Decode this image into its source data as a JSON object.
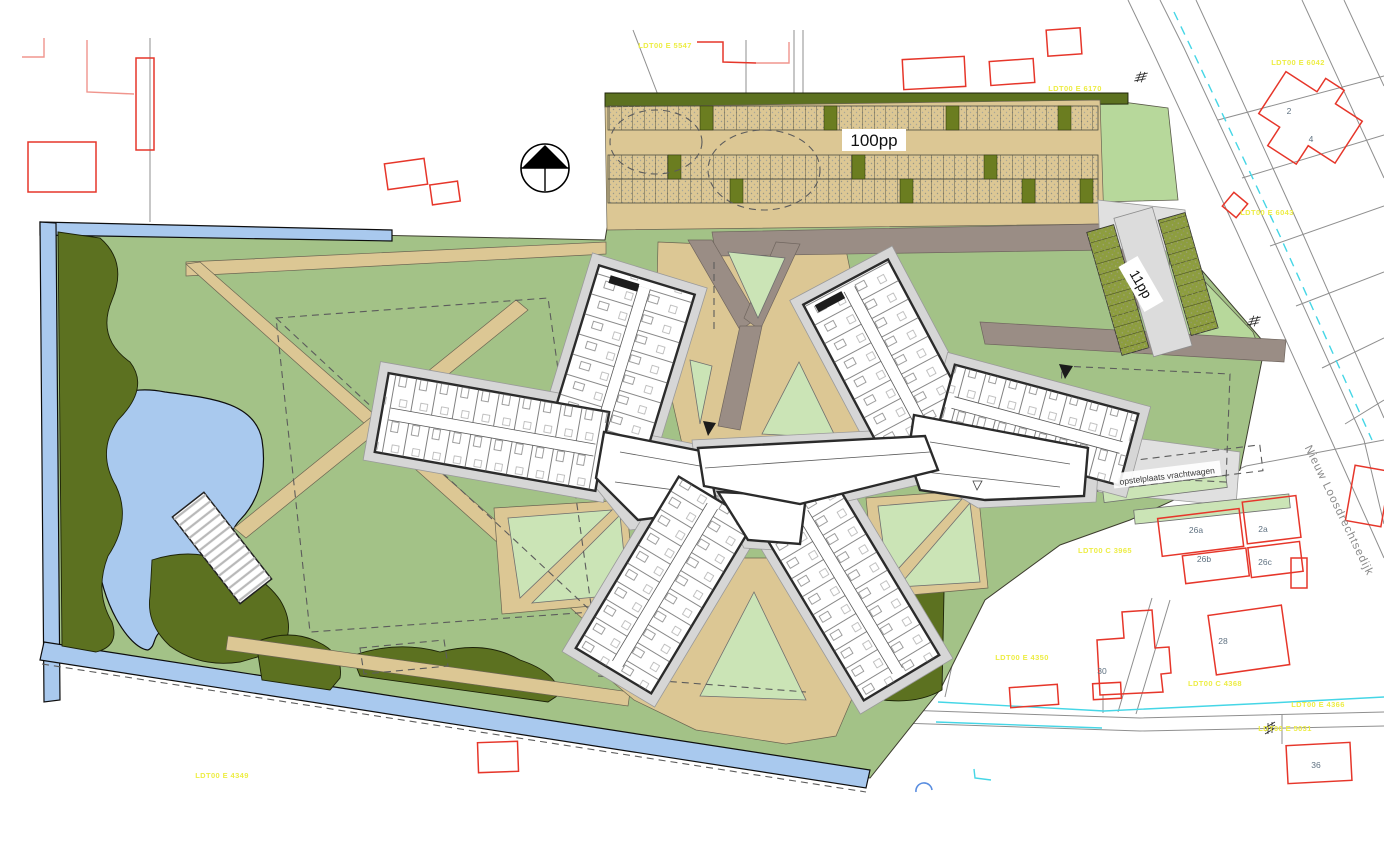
{
  "drawing": {
    "type": "architectural-site-plan",
    "labels": {
      "parking_capacity": "100pp",
      "small_parking_capacity": "11pp",
      "truck_staging_area": "opstelplaats vrachtwagen",
      "street_name": "Nieuw Loosdrechtsedijk"
    },
    "house_numbers": [
      {
        "text": "2"
      },
      {
        "text": "4"
      },
      {
        "text": "26a"
      },
      {
        "text": "2a"
      },
      {
        "text": "26b"
      },
      {
        "text": "26c"
      },
      {
        "text": "30"
      },
      {
        "text": "28"
      },
      {
        "text": "36"
      }
    ],
    "cadastral_labels": [
      {
        "text": "LDT00 E 5547"
      },
      {
        "text": "LDT00 E 6042"
      },
      {
        "text": "LDT00 E 6170"
      },
      {
        "text": "LDT00 E 6043"
      },
      {
        "text": "LDT00 C 3965"
      },
      {
        "text": "LDT00 E 4350"
      },
      {
        "text": "LDT00 C 4368"
      },
      {
        "text": "LDT00 E 4366"
      },
      {
        "text": "LDT00 E 5031"
      },
      {
        "text": "LDT00 E 4349"
      }
    ],
    "icons": {
      "north_arrow": "north-arrow-icon"
    },
    "colors": {
      "lawn_green": "#a3c287",
      "courtyard_pale_green": "#cbe4b6",
      "parcel_green": "#b7d89b",
      "hedge_dark_olive": "#5c7120",
      "water_blue": "#a9c9ee",
      "path_tan": "#dcc794",
      "road_mauve": "#9a8d85",
      "paving_gray": "#d6d6d6",
      "existing_building_red": "#e6362a",
      "cadastral_yellow": "#eded45",
      "ditch_cyan": "#45d6e6",
      "parking_stall_olive": "#8d9d3f"
    }
  }
}
